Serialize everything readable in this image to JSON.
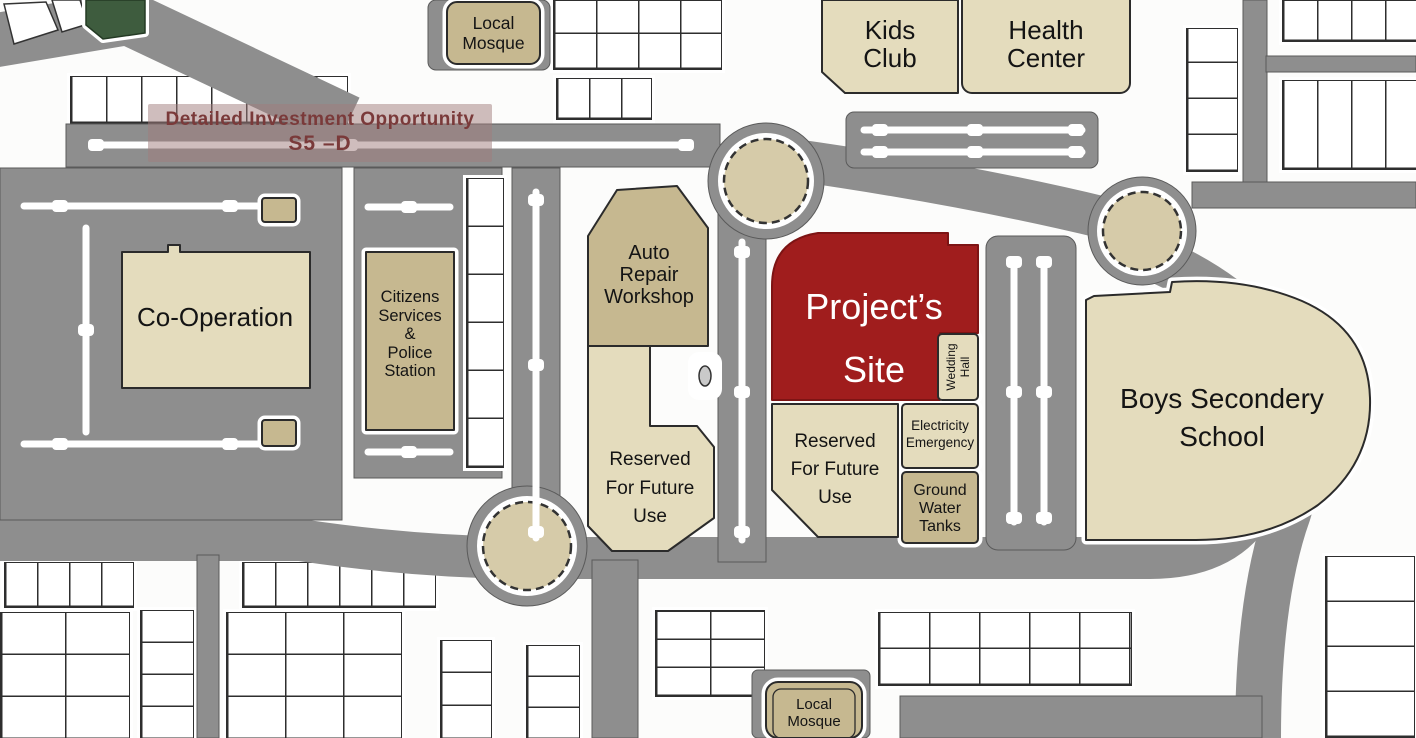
{
  "title": {
    "line1": "Detailed Investment Opportunity",
    "line2": "S5 –D"
  },
  "labels": {
    "local_mosque_top": {
      "line1": "Local",
      "line2": "Mosque"
    },
    "kids_club": {
      "line1": "Kids",
      "line2": "Club"
    },
    "health_center": {
      "line1": "Health",
      "line2": "Center"
    },
    "co_operation": {
      "line1": "Co-Operation"
    },
    "citizens_services": {
      "line1": "Citizens",
      "line2": "Services",
      "line3": "&",
      "line4": "Police",
      "line5": "Station"
    },
    "auto_repair": {
      "line1": "Auto",
      "line2": "Repair",
      "line3": "Workshop"
    },
    "projects_site": {
      "line1": "Project’s",
      "line2": "Site"
    },
    "wedding_hall": {
      "line1": "Wedding",
      "line2": "Hall"
    },
    "reserved_left": {
      "line1": "Reserved",
      "line2": "For Future",
      "line3": "Use"
    },
    "reserved_center": {
      "line1": "Reserved",
      "line2": "For Future",
      "line3": "Use"
    },
    "electricity": {
      "line1": "Electricity",
      "line2": "Emergency"
    },
    "ground_water": {
      "line1": "Ground",
      "line2": "Water",
      "line3": "Tanks"
    },
    "boys_school": {
      "line1": "Boys Secondery",
      "line2": "School"
    },
    "local_mosque_bottom": {
      "line1": "Local",
      "line2": "Mosque"
    }
  },
  "colors": {
    "road": "#8e8e8e",
    "tan-dark": "#c6b890",
    "tan-light": "#e4dcbd",
    "tan-round": "#d6cba9",
    "red": "#a01d1d",
    "green": "#3e5c3e",
    "ink": "#141414",
    "title": "#7a3a3a"
  }
}
